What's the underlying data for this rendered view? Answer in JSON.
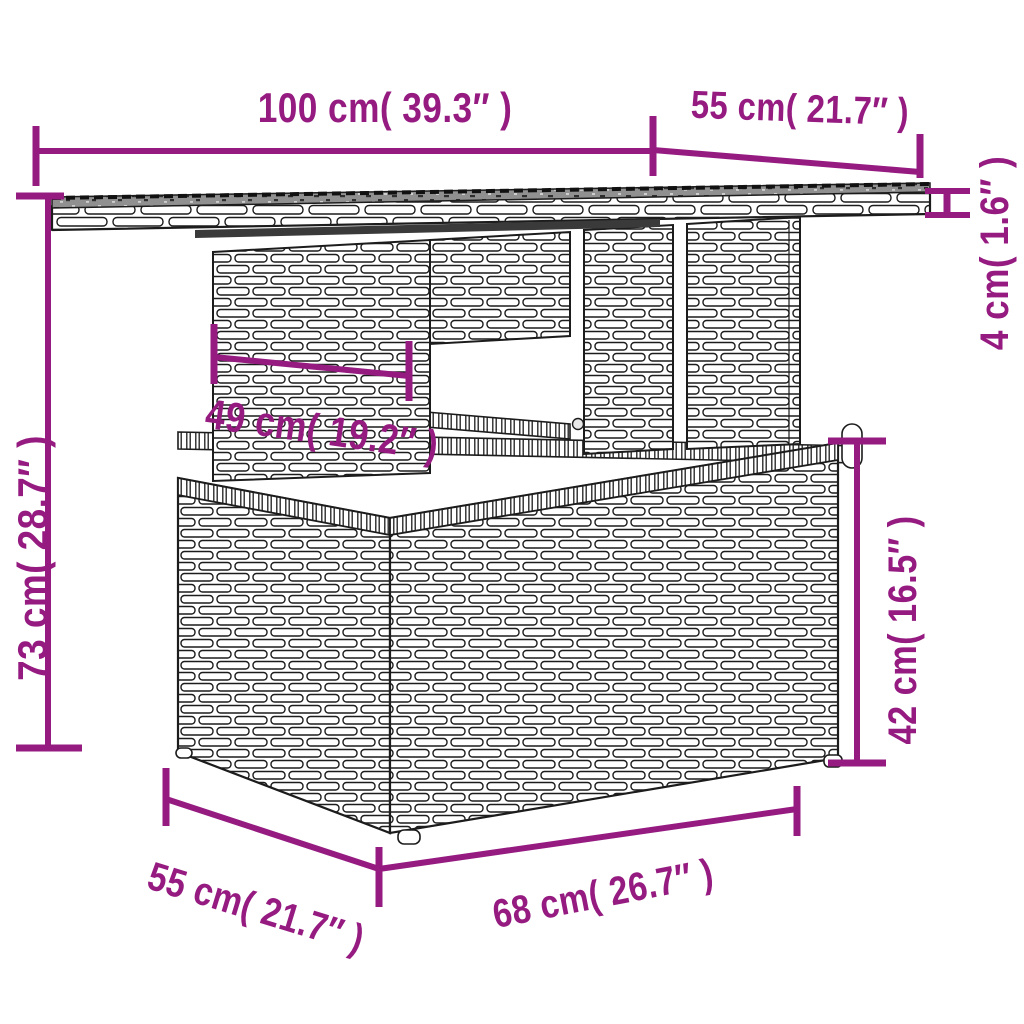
{
  "diagram": {
    "accent_color": "#951b81",
    "line_color": "#1a1a1a",
    "glass_color": "#909090",
    "dimensions": {
      "top_width": {
        "cm": 100,
        "inches": "39.3",
        "label": "100 cm( 39.3″ )"
      },
      "top_depth": {
        "cm": 55,
        "inches": "21.7",
        "label": "55 cm( 21.7″ )"
      },
      "top_thickness": {
        "cm": 4,
        "inches": "1.6",
        "label": "4 cm( 1.6″ )"
      },
      "total_height": {
        "cm": 73,
        "inches": "28.7",
        "label": "73 cm( 28.7″ )"
      },
      "understructure_width": {
        "cm": 49,
        "inches": "19.2",
        "label": "49 cm( 19.2″ )"
      },
      "base_height": {
        "cm": 42,
        "inches": "16.5",
        "label": "42 cm( 16.5″ )"
      },
      "base_width": {
        "cm": 68,
        "inches": "26.7",
        "label": "68 cm( 26.7″ )"
      },
      "base_depth": {
        "cm": 55,
        "inches": "21.7",
        "label": "55 cm( 21.7″ )"
      }
    }
  }
}
